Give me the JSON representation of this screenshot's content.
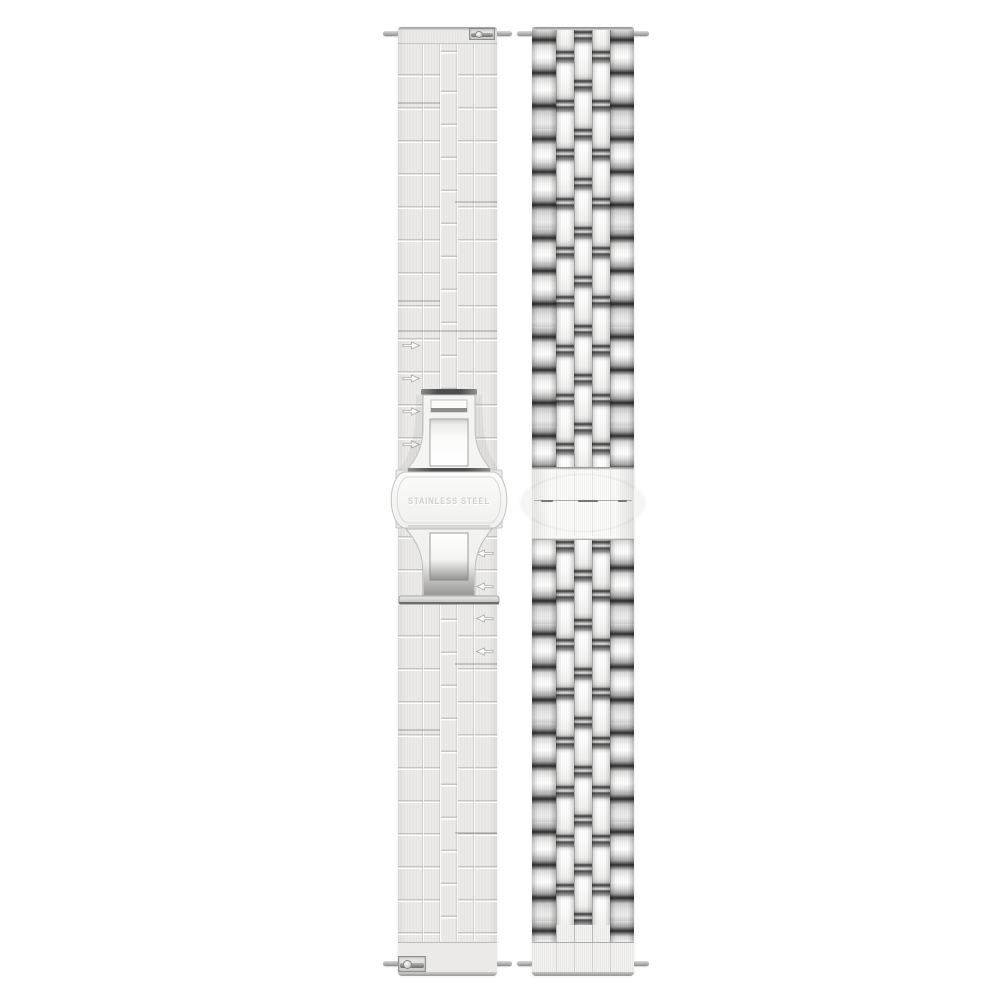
{
  "scene": {
    "type": "product-photo",
    "subject": "stainless steel watch band, back and front views",
    "background": "#ffffff"
  },
  "left_strap": {
    "view": "back view with butterfly deployant clasp",
    "engraving": "STAINLESS STEEL",
    "arrow_markers": {
      "above_clasp": 4,
      "below_clasp": 4,
      "above_direction": "right",
      "below_direction": "left"
    }
  },
  "right_strap": {
    "view": "front view, five-link bracelet with polished center links"
  },
  "palette": {
    "bg": "#ffffff",
    "brushed-light": "#ecebe9",
    "joint-dark": "#2f2f2f",
    "engraving-gray": "#cfcfcd",
    "pin-gray": "#9a9a98"
  }
}
